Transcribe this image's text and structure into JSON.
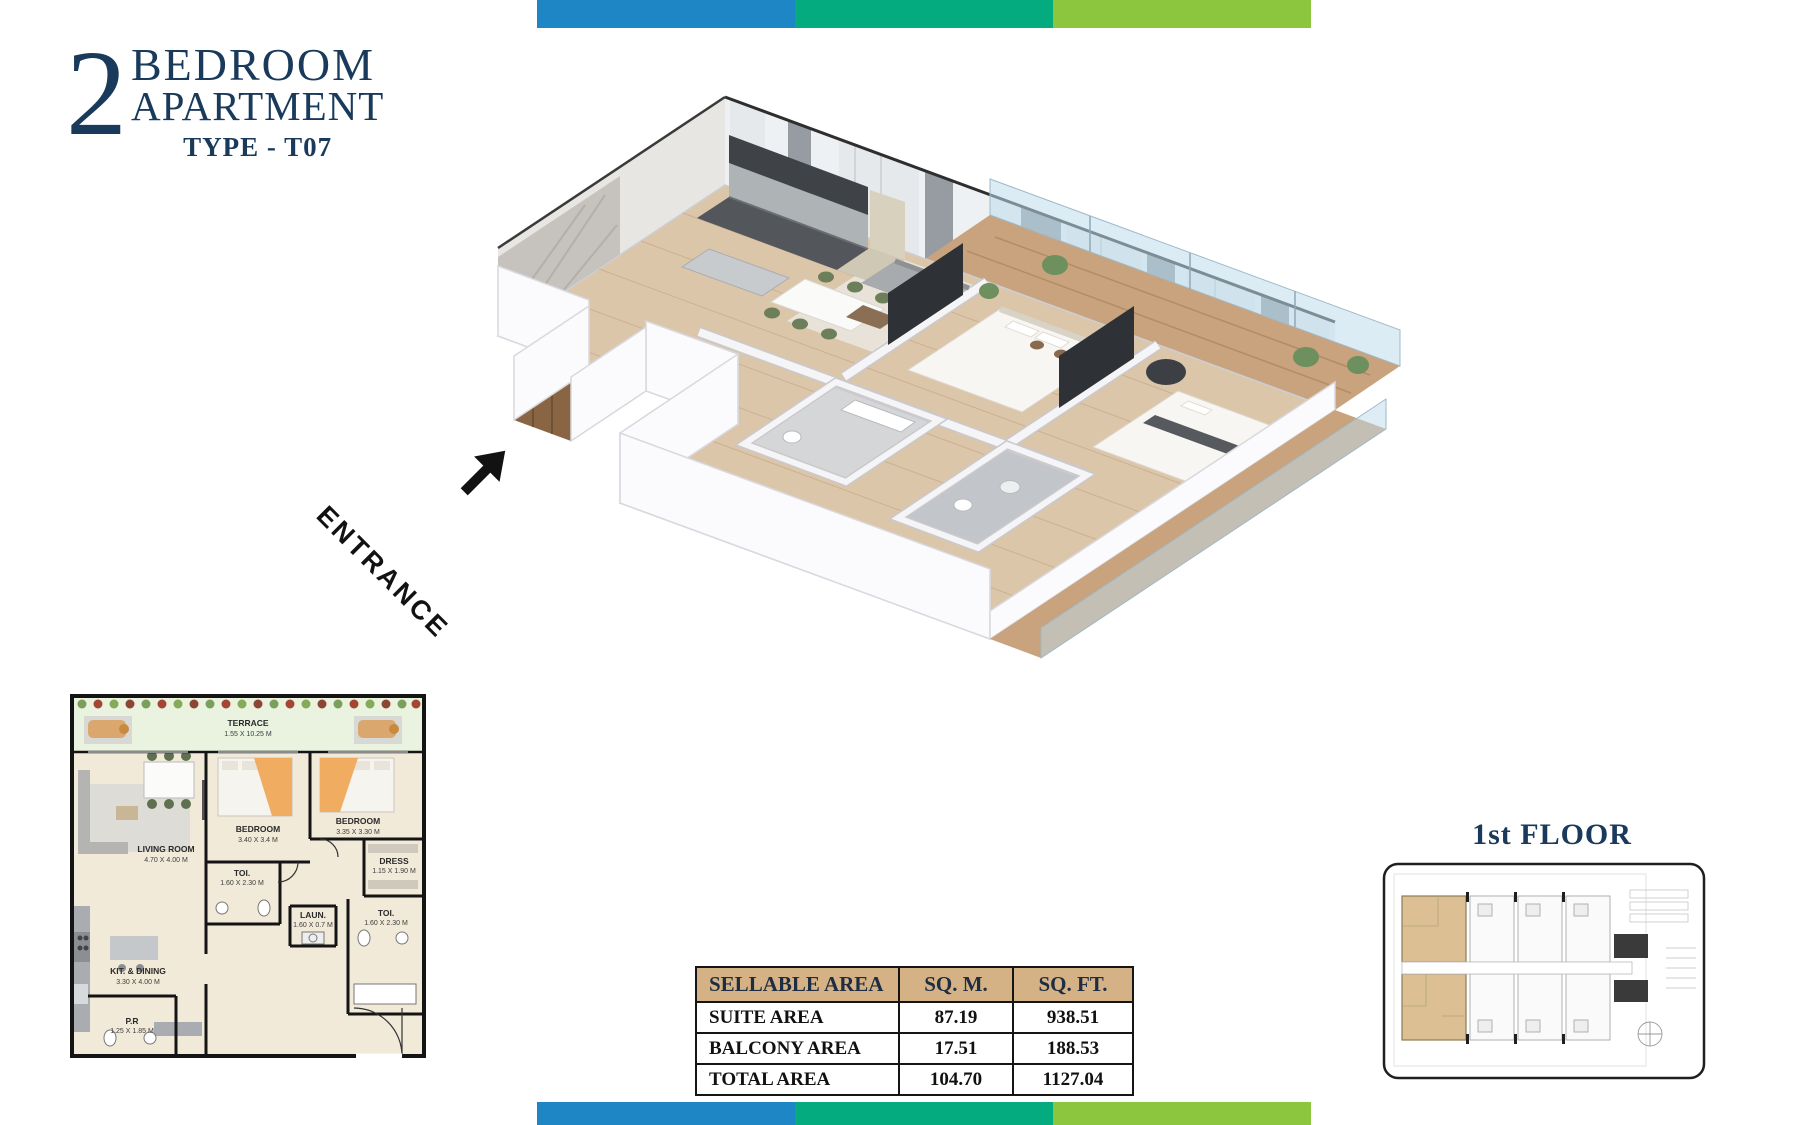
{
  "header": {
    "number": "2",
    "line1": "BEDROOM",
    "line2": "APARTMENT",
    "type_label": "TYPE - T07"
  },
  "entrance": {
    "label": "ENTRANCE"
  },
  "area_table": {
    "headers": [
      "SELLABLE AREA",
      "SQ. M.",
      "SQ. FT."
    ],
    "rows": [
      {
        "label": "SUITE AREA",
        "sqm": "87.19",
        "sqft": "938.51"
      },
      {
        "label": "BALCONY AREA",
        "sqm": "17.51",
        "sqft": "188.53"
      },
      {
        "label": "TOTAL AREA",
        "sqm": "104.70",
        "sqft": "1127.04"
      }
    ]
  },
  "miniplan": {
    "terrace": {
      "name": "TERRACE",
      "dims": "1.55 X 10.25 M"
    },
    "living": {
      "name": "LIVING ROOM",
      "dims": "4.70 X 4.00 M"
    },
    "bedroom1": {
      "name": "BEDROOM",
      "dims": "3.40 X 3.4 M"
    },
    "bedroom2": {
      "name": "BEDROOM",
      "dims": "3.35 X 3.30 M"
    },
    "toi1": {
      "name": "TOI.",
      "dims": "1.60 X 2.30 M"
    },
    "dress": {
      "name": "DRESS",
      "dims": "1.15 X 1.90 M"
    },
    "laun": {
      "name": "LAUN.",
      "dims": "1.60 X 0.7 M"
    },
    "toi2": {
      "name": "TOI.",
      "dims": "1.60 X 2.30 M"
    },
    "kitchen": {
      "name": "KIT. & DINING",
      "dims": "3.30 X 4.00 M"
    },
    "pr": {
      "name": "P.R",
      "dims": "1.25 X 1.85 M"
    }
  },
  "keyplan": {
    "title": "1st FLOOR"
  },
  "colors": {
    "navy": "#1a3a5c",
    "bar_blue": "#1f86c5",
    "bar_teal": "#04ab7f",
    "bar_green": "#8cc63f",
    "table_header_tan": "#d5b285",
    "unit_highlight_tan": "#dcc093"
  }
}
